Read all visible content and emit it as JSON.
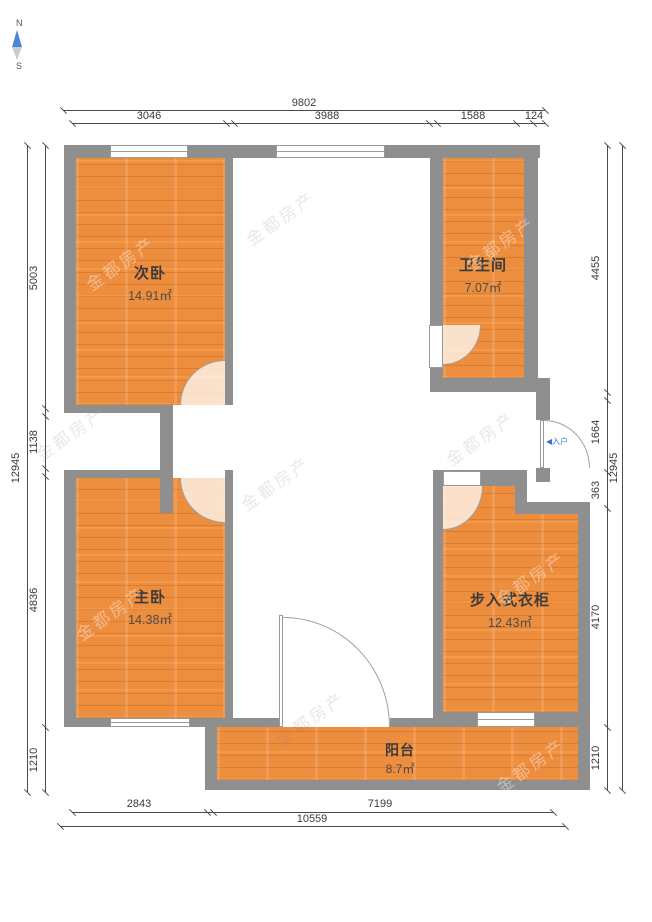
{
  "compass": {
    "north": "N",
    "south": "S"
  },
  "rooms": {
    "ciwo": {
      "name": "次卧",
      "area": "14.91㎡"
    },
    "weishengjian": {
      "name": "卫生间",
      "area": "7.07㎡"
    },
    "zhuwo": {
      "name": "主卧",
      "area": "14.38㎡"
    },
    "yigui": {
      "name": "步入式衣柜",
      "area": "12.43㎡"
    },
    "yangtai": {
      "name": "阳台",
      "area": "8.7㎡"
    }
  },
  "entrance": {
    "label": "入户",
    "arrow": "◀"
  },
  "dimensions": {
    "top": {
      "total": "9802",
      "segments": [
        "3046",
        "3988",
        "1588",
        "124"
      ]
    },
    "bottom": {
      "total": "10559",
      "segments": [
        "2843",
        "7199"
      ]
    },
    "left": {
      "total": "12945",
      "segments": [
        "5003",
        "1138",
        "4836",
        "1210"
      ]
    },
    "right": {
      "total": "12945",
      "segments": [
        "4455",
        "1664",
        "363",
        "4170",
        "1210"
      ]
    }
  },
  "watermark": {
    "text": "金都房产"
  },
  "colors": {
    "floor": "#ED8D3E",
    "wall": "#8F8F8F",
    "dimension_text": "#3A3A3A",
    "entrance_text": "#3A6FD8",
    "compass_north": "#4A85D8"
  }
}
